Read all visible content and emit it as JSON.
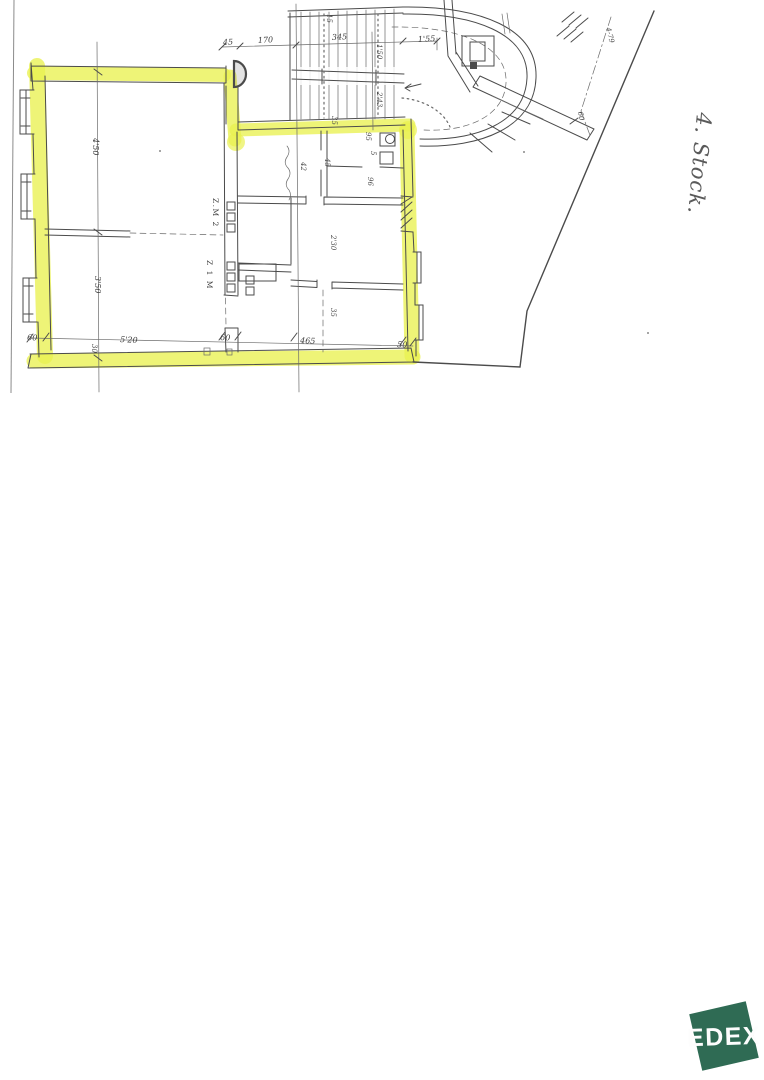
{
  "document": {
    "floor_note": "4. Stock.",
    "logo_text": "EDEX"
  },
  "plan": {
    "colors": {
      "highlight": "#e9f151",
      "ink": "#4b4b4b",
      "logo_green": "#2f6b54"
    },
    "room_labels": [
      {
        "text": "Z.M 2"
      },
      {
        "text": "Z 1 M"
      }
    ],
    "dimensions": [
      {
        "text": "45"
      },
      {
        "text": "170"
      },
      {
        "text": "345"
      },
      {
        "text": "1'55"
      },
      {
        "text": "15"
      },
      {
        "text": "1'50"
      },
      {
        "text": "2'43"
      },
      {
        "text": "35"
      },
      {
        "text": "45"
      },
      {
        "text": "42"
      },
      {
        "text": "95"
      },
      {
        "text": "5"
      },
      {
        "text": "96"
      },
      {
        "text": "4'50"
      },
      {
        "text": "3'50"
      },
      {
        "text": "2'30"
      },
      {
        "text": "35"
      },
      {
        "text": "60"
      },
      {
        "text": "5'20"
      },
      {
        "text": "30"
      },
      {
        "text": "60"
      },
      {
        "text": "465"
      },
      {
        "text": "50"
      },
      {
        "text": "60"
      },
      {
        "text": "4-79"
      }
    ]
  }
}
